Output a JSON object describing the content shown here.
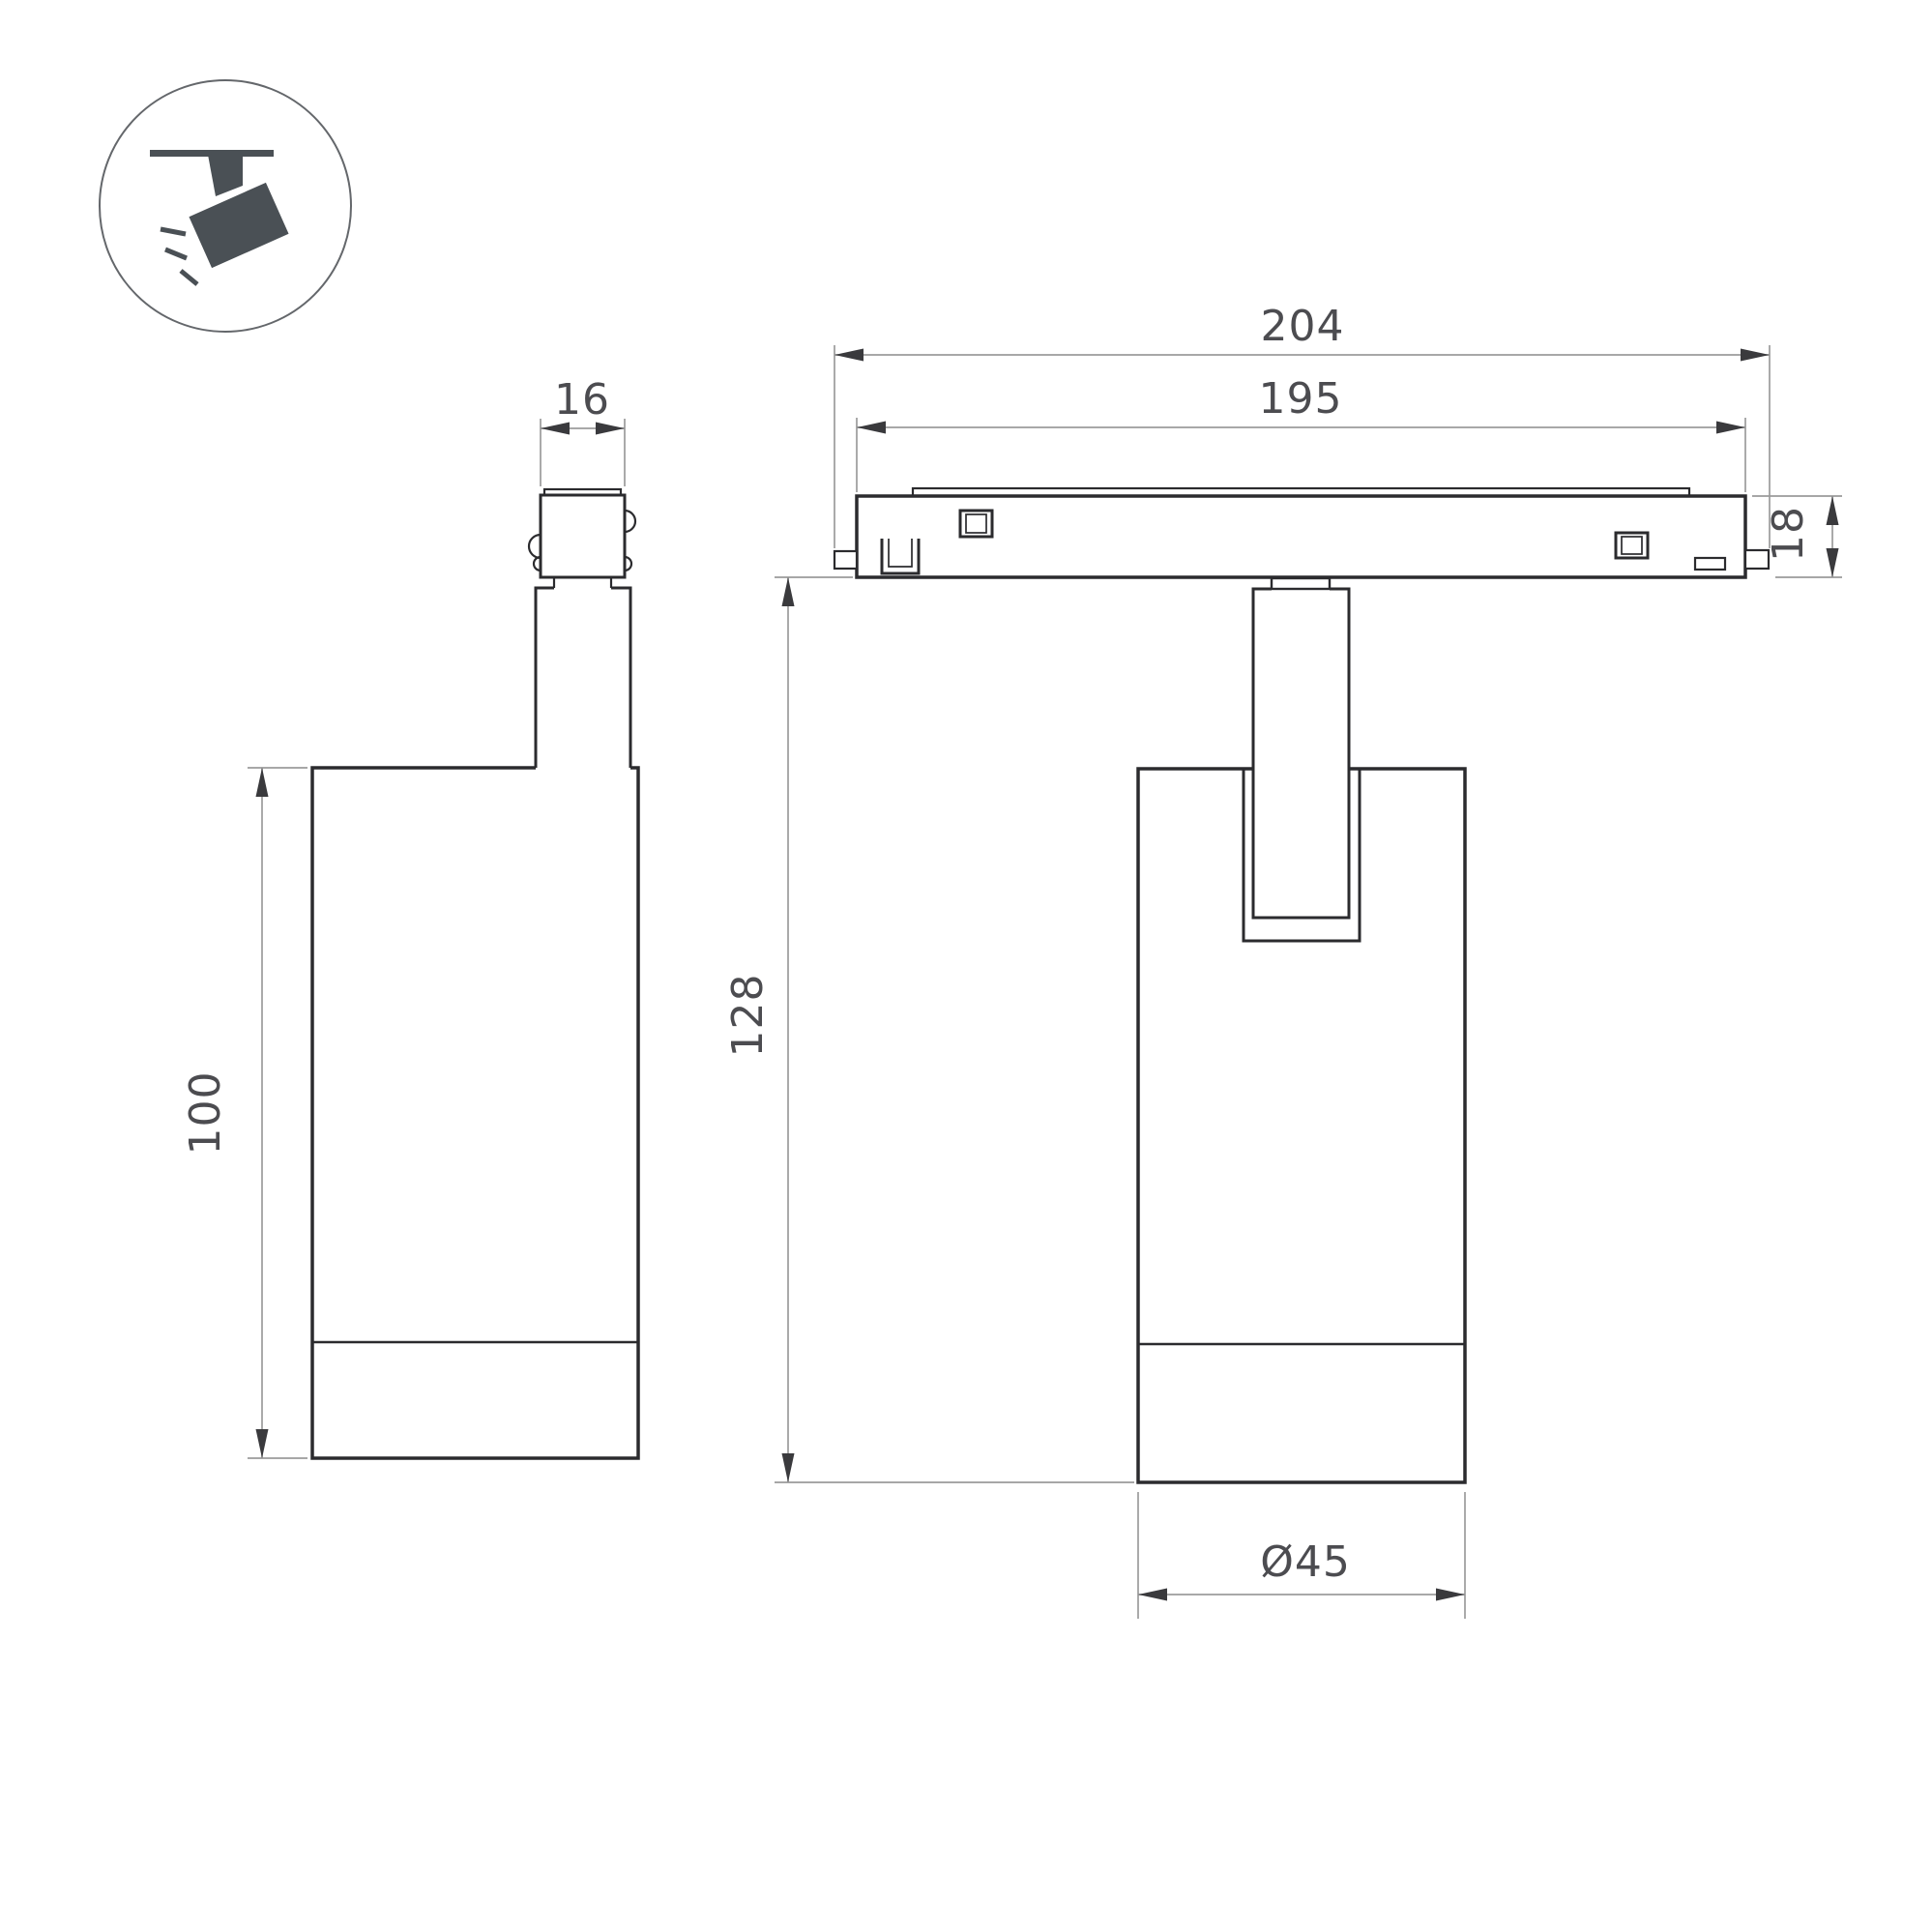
{
  "window": {
    "background": "#ffffff"
  },
  "icon_badge": {
    "name": "ceiling-track-spotlight"
  },
  "dimensions": {
    "d204": "204",
    "d195": "195",
    "d16": "16",
    "d18": "18",
    "d100": "100",
    "d128": "128",
    "d45": "Ø45"
  },
  "colors": {
    "outline": "#2b2b2e",
    "dimension_line": "#9b9b9b",
    "dimension_text": "#4c4c50",
    "arrowhead": "#3a3a3d",
    "icon_fill": "#4a5055",
    "icon_ring": "#64676b",
    "background": "#ffffff"
  }
}
